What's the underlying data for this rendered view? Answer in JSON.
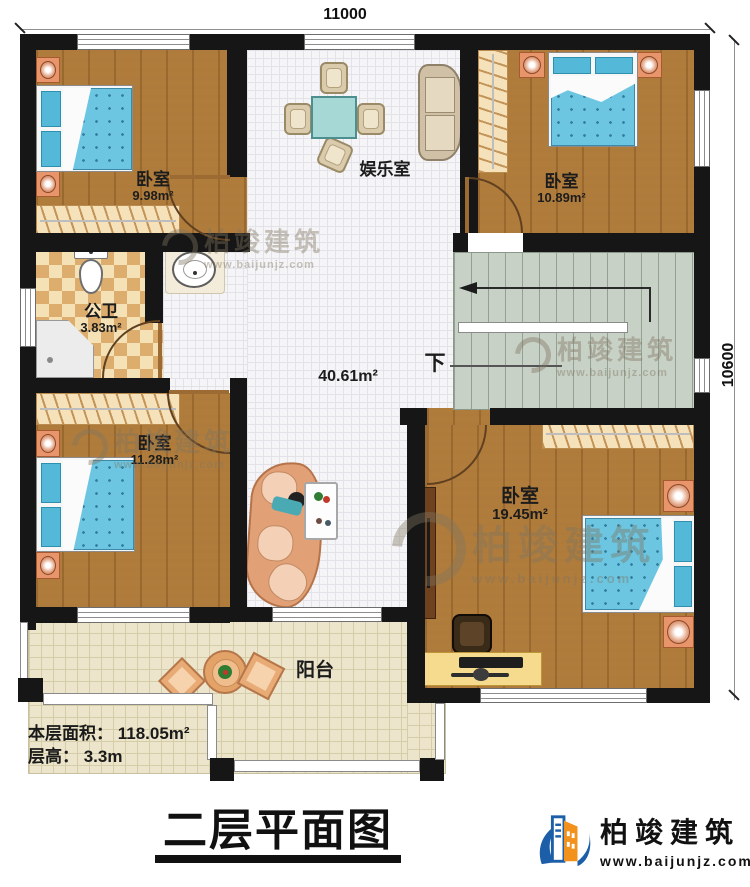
{
  "title": "二层平面图",
  "dimensions": {
    "width_label": "11000",
    "height_label": "10600"
  },
  "rooms": {
    "bedroom_tl": {
      "name": "卧室",
      "area": "9.98m²"
    },
    "entertainment": {
      "name": "娱乐室"
    },
    "bedroom_tr": {
      "name": "卧室",
      "area": "10.89m²"
    },
    "bathroom": {
      "name": "公卫",
      "area": "3.83m²"
    },
    "hall": {
      "area": "40.61m²"
    },
    "stairs": {
      "down_label": "下"
    },
    "bedroom_bl": {
      "name": "卧室",
      "area": "11.28m²"
    },
    "bedroom_br": {
      "name": "卧室",
      "area": "19.45m²"
    },
    "balcony": {
      "name": "阳台"
    }
  },
  "info": {
    "floor_area_line": "本层面积： 118.05m²",
    "floor_height_line": "层高： 3.3m"
  },
  "brand": {
    "name": "柏竣建筑",
    "url": "www.baijunjz.com"
  },
  "watermark": {
    "name": "柏竣建筑",
    "url": "www.baijunjz.com"
  },
  "colors": {
    "wall": "#161616",
    "wood": "#b07c3c",
    "bed_blue": "#6cc6e2",
    "stair": "#c7d1c6",
    "balcony_tile": "#ece5cb",
    "checker_tan": "#ddad6e",
    "logo_blue": "#1c5fa8",
    "logo_orange": "#f2921d"
  }
}
